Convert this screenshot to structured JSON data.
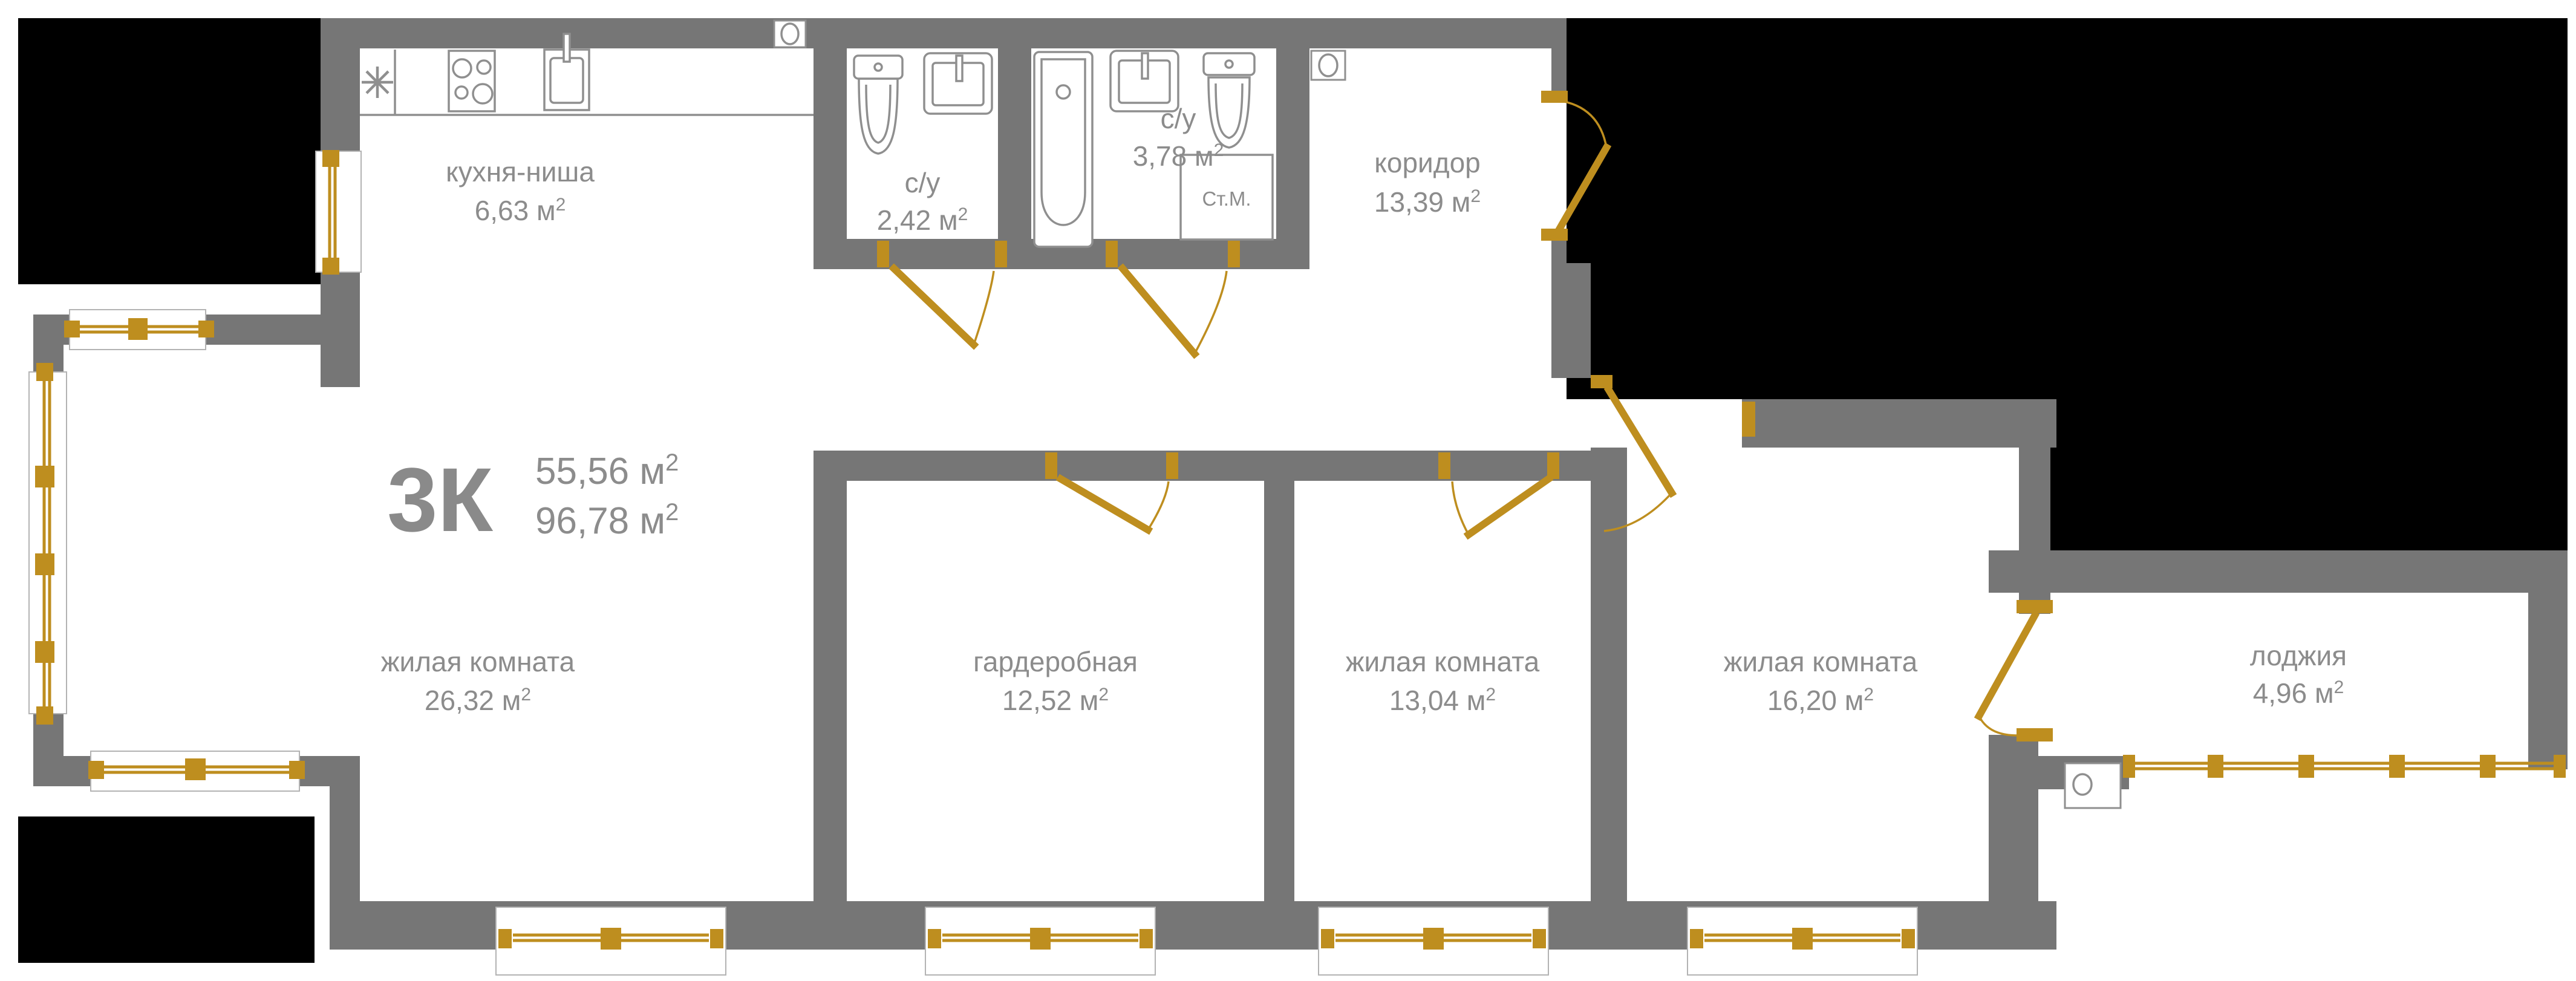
{
  "title": {
    "code": "3К",
    "area_living": "55,56 м",
    "area_total": "96,78 м"
  },
  "sup": "2",
  "rooms": [
    {
      "id": "kitchen",
      "name": "кухня-ниша",
      "area": "6,63 м"
    },
    {
      "id": "bath-small",
      "name": "с/у",
      "area": "2,42 м"
    },
    {
      "id": "bath-big",
      "name": "с/у",
      "area": "3,78 м"
    },
    {
      "id": "corridor",
      "name": "коридор",
      "area": "13,39 м"
    },
    {
      "id": "living-room-1",
      "name": "жилая комната",
      "area": "26,32 м"
    },
    {
      "id": "wardrobe",
      "name": "гардеробная",
      "area": "12,52 м"
    },
    {
      "id": "living-room-2",
      "name": "жилая комната",
      "area": "13,04 м"
    },
    {
      "id": "living-room-3",
      "name": "жилая комната",
      "area": "16,20 м"
    },
    {
      "id": "loggia",
      "name": "лоджия",
      "area": "4,96 м"
    }
  ],
  "fixtures": {
    "washing_machine_label": "Ст.М."
  },
  "icons": {
    "fridge": "asterisk-8-spoke",
    "stove": "square-4-burners",
    "sink": "double-rect-faucet",
    "toilet": "tank-and-bowl",
    "bathtub": "rounded-tub",
    "ventilation": "circle-in-niche"
  },
  "colors": {
    "wall": "#767676",
    "outside": "#000000",
    "accent_gold": "#BE8E1F",
    "label": "#8C8C8C",
    "fixture": "#8F8F8F",
    "background": "#FFFFFF"
  }
}
